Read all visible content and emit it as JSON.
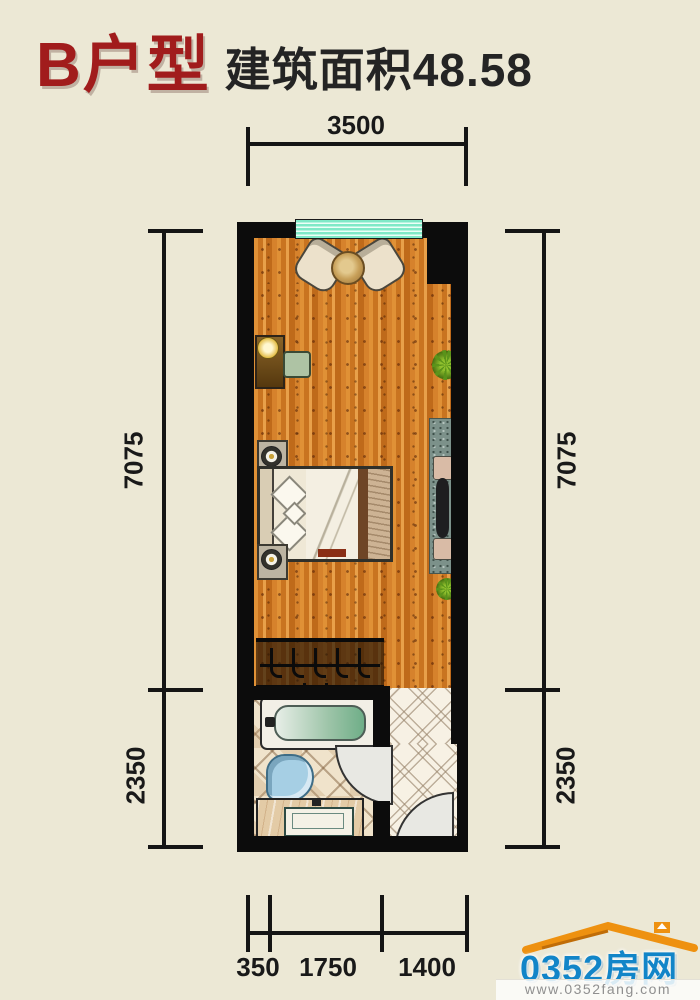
{
  "title": {
    "unit": "B户型",
    "area": "建筑面积48.58"
  },
  "dimensions": {
    "top": "3500",
    "left": {
      "upper": "7075",
      "lower": "2350"
    },
    "right": {
      "upper": "7075",
      "lower": "2350"
    },
    "bottom": {
      "a": "350",
      "b": "1750",
      "c": "1400"
    }
  },
  "watermark": {
    "brand": "0352房网",
    "url": "www.0352fang.com"
  },
  "colors": {
    "background": "#ece8d5",
    "title_red": "#a11c1c",
    "wall_black": "#0c0c0c",
    "window_teal": "#7fe9c7",
    "wood_floor": "#d0812c",
    "brand_blue": "#1285c8",
    "roof_orange": "#ee9110"
  }
}
